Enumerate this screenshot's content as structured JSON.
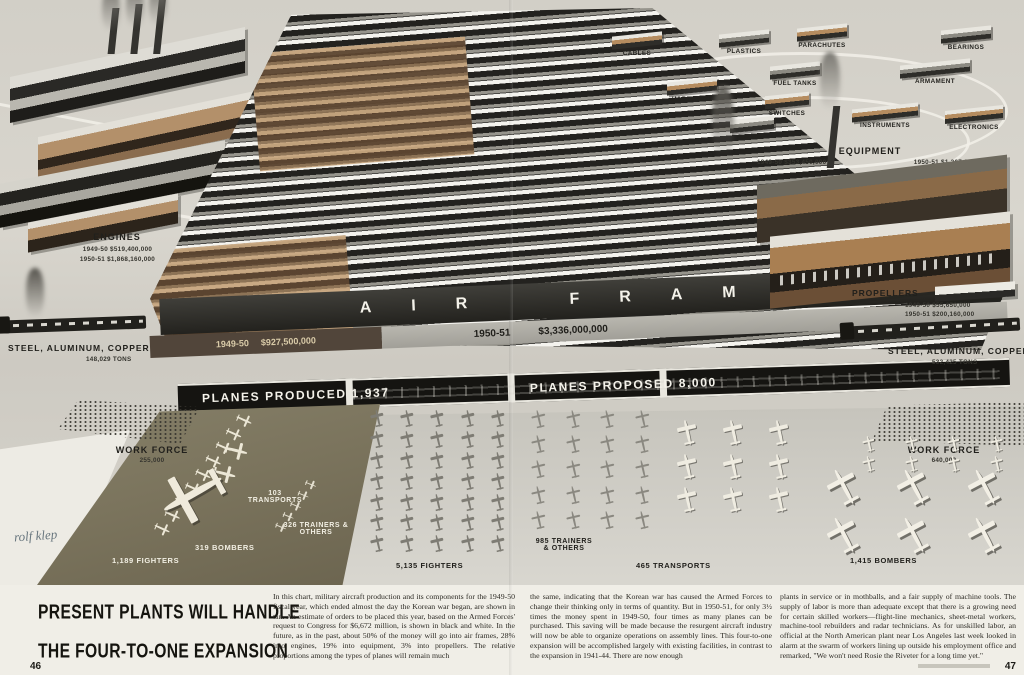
{
  "colors": {
    "paper": "#e6e3da",
    "tan_1949": "#c2a177",
    "black_1950": "#151411",
    "apron_olive": "#7b745d",
    "banner_text": "#f4f2ea"
  },
  "illustration": {
    "airframes": {
      "title": "AIR FRAMES",
      "y1949_label": "1949-50",
      "y1949_value": "$927,500,000",
      "y1950_label": "1950-51",
      "y1950_value": "$3,336,000,000",
      "produced_banner": "PLANES PRODUCED 1,937",
      "proposed_banner": "PLANES PROPOSED 8,000"
    },
    "engines": {
      "title": "ENGINES",
      "line1": "1949-50 $519,400,000",
      "line2": "1950-51 $1,868,160,000"
    },
    "equipment": {
      "title": "EQUIPMENT",
      "line1": "1949-50 $353,450,000",
      "line2": "1950-51 $1,267,680,000"
    },
    "propellers": {
      "title": "PROPELLERS",
      "line1": "1949-50 $55,650,000",
      "line2": "1950-51 $200,160,000"
    },
    "steel_left": {
      "title": "STEEL, ALUMINUM, COPPER",
      "value": "148,029 TONS"
    },
    "steel_right": {
      "title": "STEEL, ALUMINUM, COPPER",
      "value": "532,425 TONS"
    },
    "workforce_left": {
      "title": "WORK FORCE",
      "value": "255,000"
    },
    "workforce_right": {
      "title": "WORK FORCE",
      "value": "640,000"
    },
    "satellites": [
      {
        "label": "CABLES"
      },
      {
        "label": "PLASTICS"
      },
      {
        "label": "PARACHUTES"
      },
      {
        "label": "BEARINGS"
      },
      {
        "label": "HARDWARE"
      },
      {
        "label": "FUEL TANKS"
      },
      {
        "label": "ARMAMENT"
      },
      {
        "label": "SWITCHES"
      },
      {
        "label": "GEARS"
      },
      {
        "label": "INSTRUMENTS"
      },
      {
        "label": "ELECTRONICS"
      }
    ],
    "planes_1949": {
      "transports": "103 TRANSPORTS",
      "trainers": "326 TRAINERS & OTHERS",
      "bombers": "319 BOMBERS",
      "fighters": "1,189 FIGHTERS"
    },
    "planes_1950": {
      "fighters": "5,135 FIGHTERS",
      "trainers": "985 TRAINERS & OTHERS",
      "transports": "465 TRANSPORTS",
      "bombers": "1,415 BOMBERS"
    },
    "signature": "rolf klep"
  },
  "article": {
    "headline_line1": "PRESENT PLANTS WILL HANDLE",
    "headline_line2": "THE FOUR-TO-ONE EXPANSION",
    "col1": "In this chart, military aircraft production and its components for the 1949-50 fiscal year, which ended almost the day the Korean war began, are shown in tan. An estimate of orders to be placed this year, based on the Armed Forces' request to Congress for $6,672 million, is shown in black and white. In the future, as in the past, about 50% of the money will go into air frames, 28% into engines, 19% into equipment, 3% into propellers. The relative proportions among the types of planes will remain much",
    "col2": "the same, indicating that the Korean war has caused the Armed Forces to change their thinking only in terms of quantity. But in 1950-51, for only 3½ times the money spent in 1949-50, four times as many planes can be purchased. This saving will be made because the resurgent aircraft industry will now be able to organize operations on assembly lines. This four-to-one expansion will be accomplished largely with existing facilities, in contrast to the expansion in 1941-44. There are now enough",
    "col3": "plants in service or in mothballs, and a fair supply of machine tools. The supply of labor is more than adequate except that there is a growing need for certain skilled workers—flight-line mechanics, sheet-metal workers, machine-tool rebuilders and radar technicians. As for unskilled labor, an official at the North American plant near Los Angeles last week looked in alarm at the swarm of workers lining up outside his employment office and remarked, \"We won't need Rosie the Riveter for a long time yet.\"",
    "page_left": "46",
    "page_right": "47"
  }
}
